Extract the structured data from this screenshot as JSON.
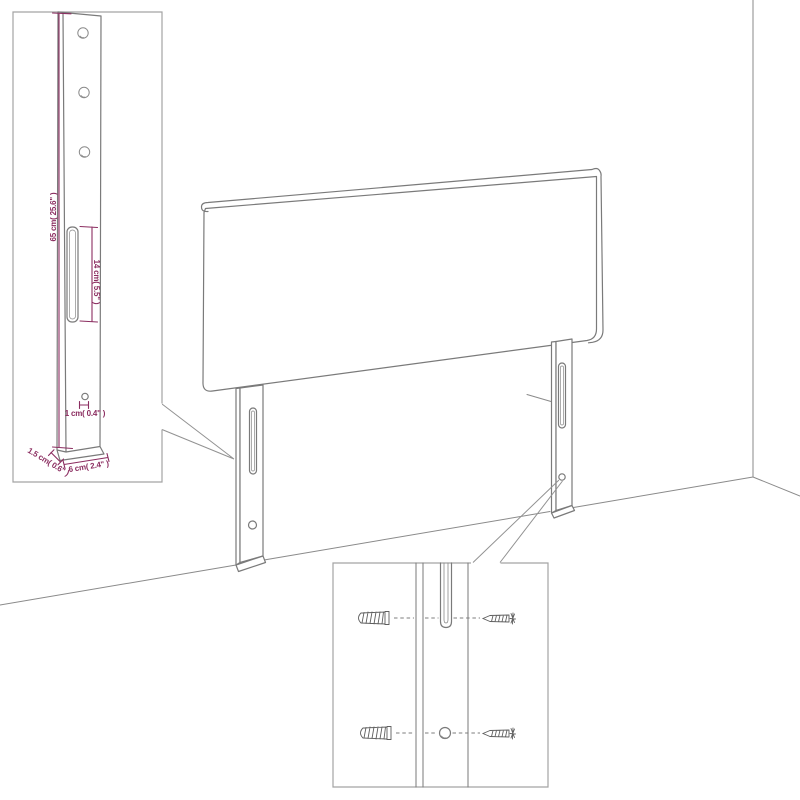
{
  "figure": {
    "kind": "furniture dimension diagram",
    "subject": "headboard with two slotted legs standing against a wall corner",
    "background": "#ffffff"
  },
  "colors": {
    "dimension_accent": "#8b2d60",
    "drawing_line": "#7a7a7a",
    "inset_border": "#a3a3a3",
    "hardware_line": "#5f5f5f"
  },
  "main_drawing": {
    "elements": [
      "wall-corner",
      "floor-line",
      "headboard-panel",
      "left-leg",
      "right-leg",
      "left-leg-slot",
      "right-leg-slot",
      "left-leg-hole",
      "right-leg-hole"
    ]
  },
  "inset_leg_detail": {
    "position": "top-left",
    "shows": "enlarged leg post with three mounting holes, long slot and small hole",
    "dimensions": {
      "post_height": "65 cm( 25.6\" )",
      "slot_length": "14 cm( 5.5\" )",
      "hole_diameter": "1 cm( 0.4\" )",
      "post_thickness": "1.5 cm( 0.6\" )",
      "post_width": "6 cm( 2.4\" )"
    }
  },
  "inset_hardware_detail": {
    "position": "bottom-center",
    "shows": "leg slot and hole with matching wall anchors and screws",
    "items": [
      "wall-anchor-top",
      "screw-top",
      "wall-anchor-bottom",
      "screw-bottom",
      "slot",
      "hole"
    ]
  }
}
